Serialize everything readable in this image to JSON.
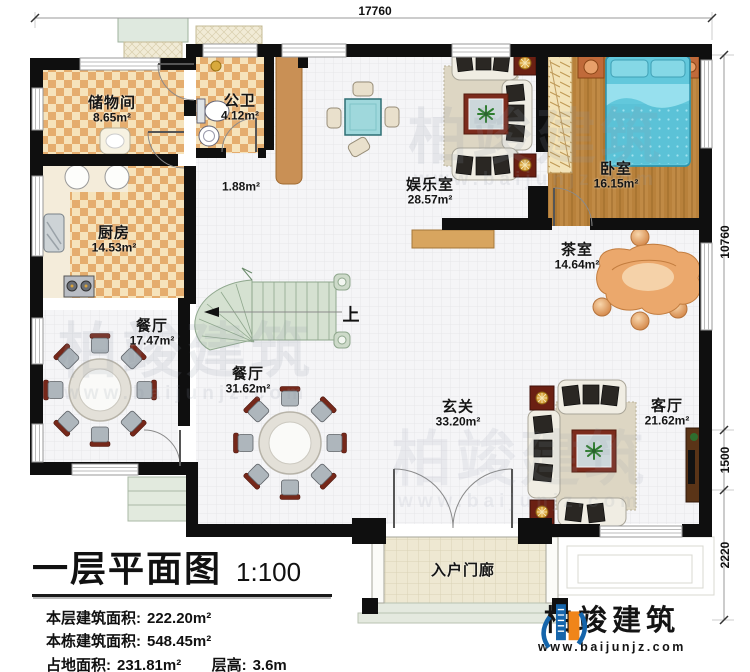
{
  "dimensions": {
    "top": "17760",
    "right": [
      "10760",
      "1500",
      "2220"
    ]
  },
  "rooms": {
    "storage": {
      "name": "储物间",
      "area": "8.65m²"
    },
    "bath": {
      "name": "公卫",
      "area": "4.12m²"
    },
    "corridor": {
      "area": "1.88m²"
    },
    "entertainment": {
      "name": "娱乐室",
      "area": "28.57m²"
    },
    "bedroom": {
      "name": "卧室",
      "area": "16.15m²"
    },
    "kitchen": {
      "name": "厨房",
      "area": "14.53m²"
    },
    "dining_private": {
      "name": "餐厅",
      "area": "17.47m²"
    },
    "tea_room": {
      "name": "茶室",
      "area": "14.64m²"
    },
    "dining_open": {
      "name": "餐厅",
      "area": "31.62m²"
    },
    "foyer": {
      "name": "玄关",
      "area": "33.20m²"
    },
    "living": {
      "name": "客厅",
      "area": "21.62m²"
    },
    "porch": {
      "name": "入户门廊"
    }
  },
  "stairs": {
    "up": "上"
  },
  "title_block": {
    "title": "一层平面图",
    "scale": "1:100",
    "info": [
      {
        "label": "本层建筑面积:",
        "value": "222.20m²"
      },
      {
        "label": "本栋建筑面积:",
        "value": "548.45m²"
      },
      {
        "label": "占地面积:",
        "value": "231.81m²"
      },
      {
        "label": "层高:",
        "value": "3.6m"
      }
    ]
  },
  "logo": {
    "name": "柏竣建筑",
    "website": "www.baijunjz.com"
  },
  "watermark": {
    "text": "柏竣建筑",
    "subtext": "www.baijunjz.com"
  },
  "colors": {
    "wall": "#0f0f0f",
    "checker_dark": "#e5ad6e",
    "checker_light": "#f6e3bb",
    "wood": "#b8813b",
    "stair": "#d5e1d1",
    "bed": "#62c8dc",
    "logo_blue": "#1565ab",
    "logo_orange": "#f08519"
  }
}
